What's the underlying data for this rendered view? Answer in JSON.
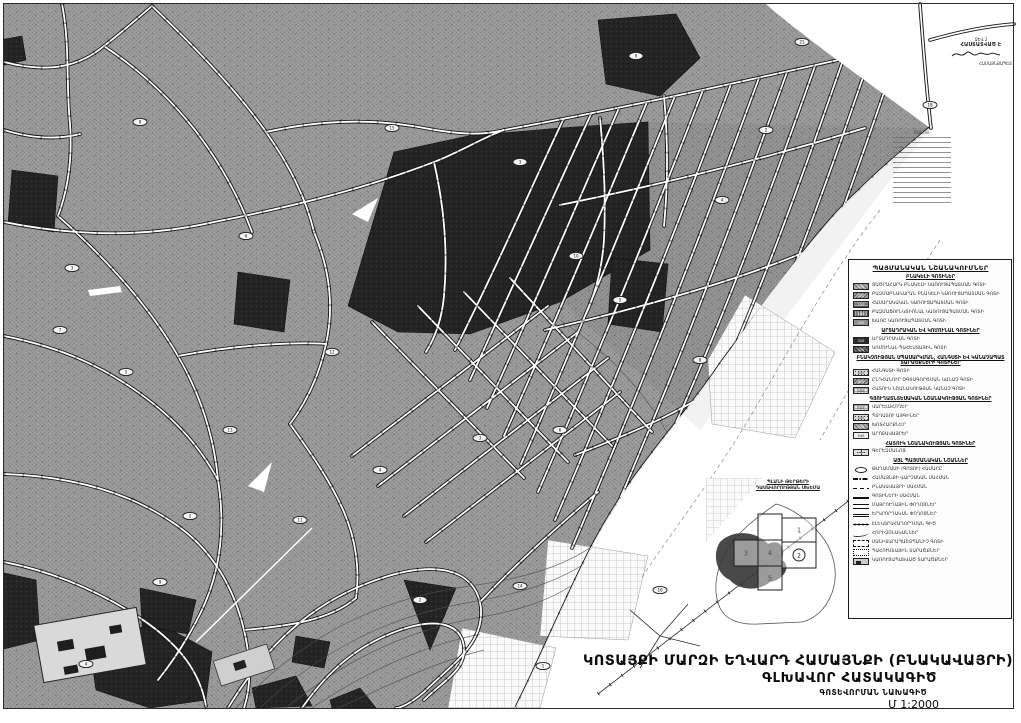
{
  "colors": {
    "urban_gray": "#9a9a9a",
    "dark_zone": "#262626",
    "paper": "#ffffff",
    "ink": "#1a1a1a"
  },
  "title_block": {
    "line1": "ԿՈՏԱՅՔԻ ՄԱՐԶԻ ԵՂՎԱՐԴ ՀԱՄԱՅՆՔԻ (ԲՆԱԿԱՎԱՅՐԻ)",
    "line2": "ԳԼԽԱՎՈՐ ՀԱՏԱԿԱԳԻԾ",
    "line3": "ԳՈՏԵՎՈՐՄԱՆ ՆԱԽԱԳԻԾ",
    "line4": "Մ 1:2000"
  },
  "legend": {
    "title": "ՊԱՅՄԱՆԱԿԱՆ ՆՇԱՆԱԿՈՒՄՆԵՐ",
    "sections": [
      {
        "header": "ԲՆԱԿԵԼԻ ԳՈՏԻՆԵՐ",
        "items": [
          {
            "style": "ht1",
            "code": "210",
            "label": "ՑԱԾՐԱՀԱՐԿ ԲՆԱԿԵԼԻ ԿԱՌՈՒՑԱՊԱՏՄԱՆ ԳՈՏԻ"
          },
          {
            "style": "ht2",
            "code": "220",
            "label": "ԲԱԶՄԱԲՆԱԿԱՐԱՆ ԲՆԱԿԵԼԻ ԿԱՌՈՒՑԱՊԱՏՄԱՆ ԳՈՏԻ"
          },
          {
            "style": "ht3",
            "code": "230",
            "label": "ՀԱՍԱՐԱԿԱԿԱՆ ԿԱՌՈՒՑԱՊԱՏՄԱՆ ԳՈՏԻ"
          },
          {
            "style": "ht4",
            "code": "240",
            "label": "ԲԱԶՄԱՖՈՒՆԿՑԻՈՆԱԼ ԿԱՌՈՒՑԱՊԱՏՄԱՆ ԳՈՏԻ"
          },
          {
            "style": "ht5",
            "code": "250",
            "label": "ԽԱՌԸ ԿԱՌՈՒՑԱՊԱՏՄԱՆ ԳՈՏԻ"
          }
        ]
      },
      {
        "header": "ԱՐՏԱԴՐԱԿԱՆ ԵՎ ԿՈՄՈՒՆԱԼ ԳՈՏԻՆԵՐ",
        "items": [
          {
            "style": "solid",
            "code": "310",
            "label": "ԱՐՏԱԴՐԱԿԱՆ ԳՈՏԻ"
          },
          {
            "style": "htdark",
            "code": "320",
            "label": "ԿՈՄՈՒՆԱԼ-ՊԱՀԵՍՏԱՅԻՆ ԳՈՏԻ"
          }
        ]
      },
      {
        "header": "ԲՆԱԿՉՈՒԹՅԱՆ ՍՊԱՍԱՐԿՄԱՆ, ՀԱՆԳՍՏԻ ԵՎ ԿԱՆԱՉԱՊԱՏ ՏԱՐԱԾՔՆԵՐԻ ԳՈՏԻՆԵՐ",
        "items": [
          {
            "style": "dots",
            "code": "410",
            "label": "ՀԱՆԳՍՏԻ ԳՈՏԻ"
          },
          {
            "style": "ht2",
            "code": "420",
            "label": "ԸՆԴՀԱՆՈՒՐ ՕԳՏԱԳՈՐԾՄԱՆ ԿԱՆԱՉ ԳՈՏԻ"
          },
          {
            "style": "grid",
            "code": "430",
            "label": "ՀԱՏՈՒԿ ՆՇԱՆԱԿՈՒԹՅԱՆ ԿԱՆԱՉ ԳՈՏԻ"
          }
        ]
      },
      {
        "header": "ԳՅՈՒՂԱՏՆՏԵՍԱԿԱՆ ՆՇԱՆԱԿՈՒԹՅԱՆ ԳՈՏԻՆԵՐ",
        "items": [
          {
            "style": "grid",
            "code": "510",
            "label": "ՎԱՐԵԼԱՀՈՂԵՐ"
          },
          {
            "style": "dots",
            "code": "520",
            "label": "ՊՏՂԱՏՈՒ ԱՅԳԻՆԵՐ"
          },
          {
            "style": "ht1",
            "code": "530",
            "label": "ԽՈՏՀԱՐՔՆԵՐ"
          },
          {
            "style": "empty",
            "code": "540",
            "label": "ԱՐՈՏԱՎԱՅՐԵՐ"
          }
        ]
      },
      {
        "header": "ՀԱՏՈՒԿ ՆՇԱՆԱԿՈՒԹՅԱՆ ԳՈՏԻՆԵՐ",
        "items": [
          {
            "style": "cross",
            "code": "610",
            "label": "ԳԵՐԵԶՄԱՆՈՑ"
          }
        ]
      },
      {
        "header": "ԱՅԼ ՊԱՅՄԱՆԱԿԱՆ ՆՇԱՆՆԵՐ",
        "items": [
          {
            "style": "oval",
            "code": "",
            "label": "ԹԱՂԱՄԱՍԻ (ԳՈՏՈՒ) ՀԱՄԱՐԸ"
          },
          {
            "style": "dashdot",
            "code": "",
            "label": "ՀԱՄԱՅՆՔԻ ՎԱՐՉԱԿԱՆ ՍԱՀՄԱՆ"
          },
          {
            "style": "dash",
            "code": "",
            "label": "ԲՆԱԿԱՎԱՅՐԻ ՍԱՀՄԱՆ"
          },
          {
            "style": "line2",
            "code": "",
            "label": "ԳՈՏԻՆԵՐԻ ՍԱՀՄԱՆ"
          },
          {
            "style": "road1",
            "code": "",
            "label": "ՄԱՅՐՈՒՂԱՅԻՆ ՓՈՂՈՑՆԵՐ"
          },
          {
            "style": "road2",
            "code": "",
            "label": "ԵՐԿՐՈՐԴԱԿԱՆ ՓՈՂՈՑՆԵՐ"
          },
          {
            "style": "power",
            "code": "",
            "label": "ԷԼԵԿՏՐԱՀԱՂՈՐԴՄԱՆ ԳԻԾ"
          },
          {
            "style": "curve",
            "code": "",
            "label": "ՀՈՐԻԶՈՆԱԿԱՆՆԵՐ"
          },
          {
            "style": "dashrect",
            "code": "",
            "label": "ՍԱՆԻՏԱՐԱՊԱՇՏՊԱՆԻՉ ԳՈՏԻ"
          },
          {
            "style": "dotrect",
            "code": "",
            "label": "ՊԱՀՈՒՍՏԱՅԻՆ ՏԱՐԱԾՔՆԵՐ"
          },
          {
            "style": "bld",
            "code": "",
            "label": "ԿԱՌՈՒՑԱՊԱՏՎԱԾ ՏԱՐԱԾՔՆԵՐ"
          }
        ]
      }
    ]
  },
  "inset": {
    "header_line1": "ՊԼԱՆԻ ԹԵՐԹԵՐԻ",
    "header_line2": "ԴԱՍԱՎՈՐՈՒԹՅԱՆ ՍԽԵՄԱ",
    "circled_number": "2",
    "sheets": [
      {
        "x": 52,
        "y": 36,
        "w": 24,
        "h": 26,
        "n": ""
      },
      {
        "x": 76,
        "y": 40,
        "w": 34,
        "h": 24,
        "n": "1"
      },
      {
        "x": 76,
        "y": 64,
        "w": 34,
        "h": 26,
        "n": "2"
      },
      {
        "x": 28,
        "y": 62,
        "w": 24,
        "h": 26,
        "n": "3"
      },
      {
        "x": 52,
        "y": 62,
        "w": 24,
        "h": 26,
        "n": "4"
      },
      {
        "x": 52,
        "y": 88,
        "w": 24,
        "h": 24,
        "n": "5"
      }
    ]
  },
  "stamp": {
    "line1": "ՁԵՎ 2",
    "line2": "ՀԱՍՏԱՏՎԱԾ Է",
    "line3": "ՀԱՄԱՅՆՔԱՊԵՏ"
  },
  "notes": {
    "caption": "ԾԱՆՈԹ."
  },
  "map": {
    "region_labels": [
      {
        "x": 140,
        "y": 122,
        "t": "8"
      },
      {
        "x": 72,
        "y": 268,
        "t": "3"
      },
      {
        "x": 126,
        "y": 372,
        "t": "5"
      },
      {
        "x": 190,
        "y": 516,
        "t": "2"
      },
      {
        "x": 160,
        "y": 582,
        "t": "9"
      },
      {
        "x": 86,
        "y": 664,
        "t": "4"
      },
      {
        "x": 246,
        "y": 236,
        "t": "6"
      },
      {
        "x": 332,
        "y": 352,
        "t": "12"
      },
      {
        "x": 392,
        "y": 128,
        "t": "15"
      },
      {
        "x": 576,
        "y": 256,
        "t": "10"
      },
      {
        "x": 520,
        "y": 162,
        "t": "3"
      },
      {
        "x": 300,
        "y": 520,
        "t": "11"
      },
      {
        "x": 420,
        "y": 600,
        "t": "2"
      },
      {
        "x": 520,
        "y": 586,
        "t": "14"
      },
      {
        "x": 620,
        "y": 300,
        "t": "5"
      },
      {
        "x": 700,
        "y": 360,
        "t": "8"
      },
      {
        "x": 560,
        "y": 430,
        "t": "6"
      },
      {
        "x": 380,
        "y": 470,
        "t": "4"
      },
      {
        "x": 230,
        "y": 430,
        "t": "13"
      },
      {
        "x": 60,
        "y": 330,
        "t": "7"
      },
      {
        "x": 480,
        "y": 438,
        "t": "3"
      },
      {
        "x": 660,
        "y": 590,
        "t": "16"
      },
      {
        "x": 802,
        "y": 42,
        "t": "21"
      },
      {
        "x": 930,
        "y": 105,
        "t": "18"
      },
      {
        "x": 636,
        "y": 56,
        "t": "9"
      },
      {
        "x": 766,
        "y": 130,
        "t": "2"
      },
      {
        "x": 722,
        "y": 200,
        "t": "4"
      },
      {
        "x": 543,
        "y": 666,
        "t": "1"
      }
    ]
  }
}
